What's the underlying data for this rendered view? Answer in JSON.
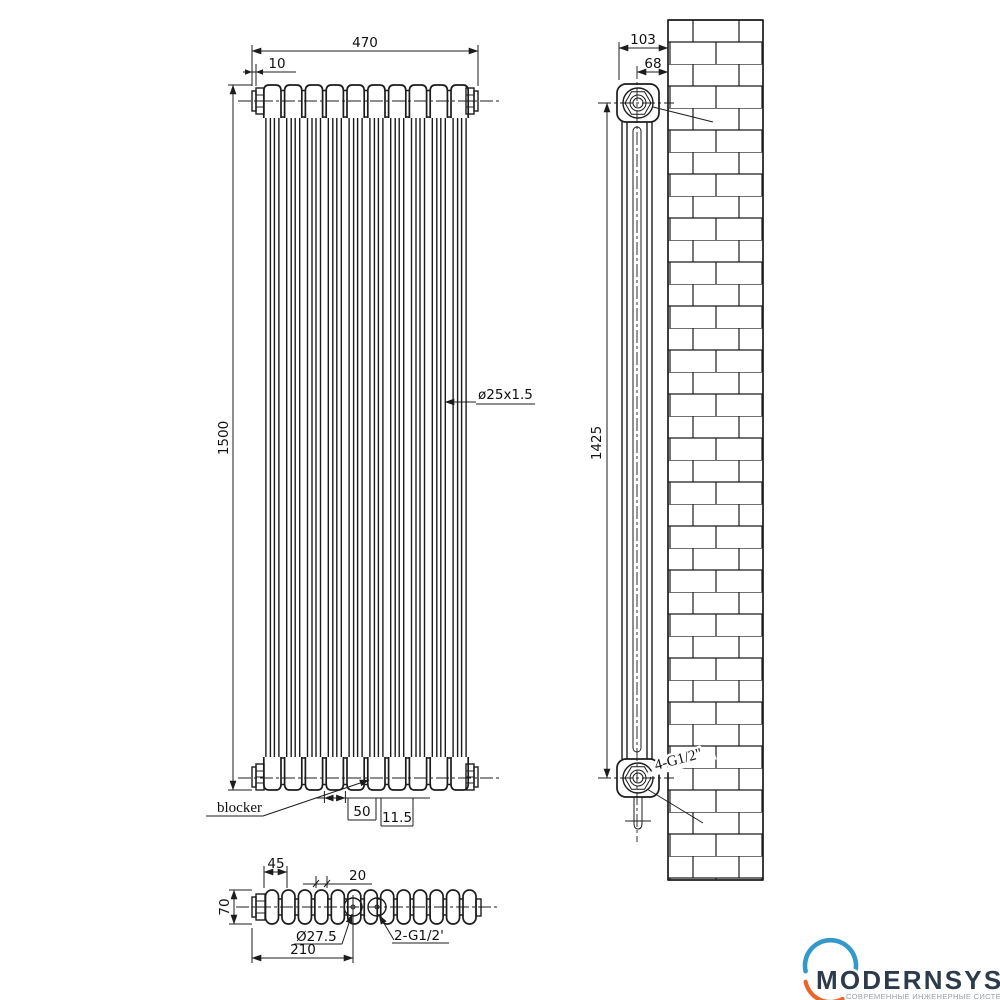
{
  "drawing": {
    "front_view": {
      "overall_width": "470",
      "cap_width": "10",
      "overall_height": "1500",
      "tube_spec": "ø25x1.5",
      "blocker_label": "blocker",
      "inlet_spacing": "50",
      "inlet_offset": "11.5"
    },
    "side_view": {
      "depth": "103",
      "wall_distance": "68",
      "height": "1425",
      "connections": "4-G1/2\""
    },
    "top_view": {
      "end_section": "45",
      "tube_pitch": "20",
      "depth": "70",
      "inlet_diameter": "Ø27.5",
      "inlet_distance": "210",
      "inlets": "2-G1/2'"
    }
  },
  "logo": {
    "brand": "MODERNSYS",
    "tagline": "СОВРЕМЕННЫЕ ИНЖЕНЕРНЫЕ СИСТЕМЫ"
  },
  "colors": {
    "line": "#1c1c1c",
    "brand_blue": "#3399cc",
    "brand_orange": "#e8662c",
    "logo_text": "#2b3b4c",
    "tagline_gray": "#9aa0a6"
  }
}
